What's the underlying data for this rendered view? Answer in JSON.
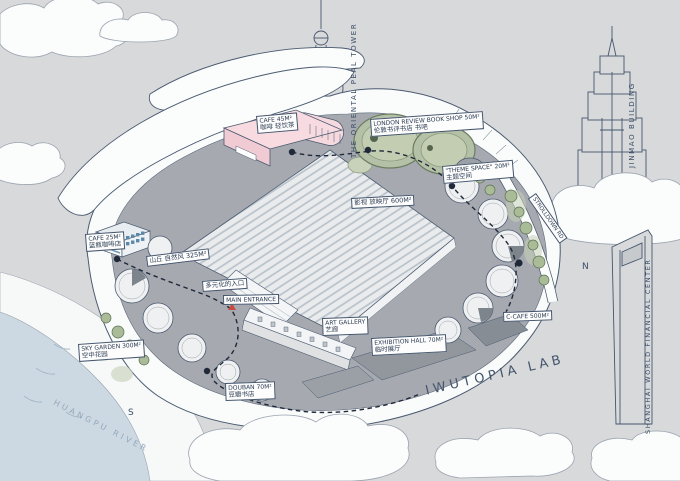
{
  "site": {
    "name": "IWUTOPIA LAB",
    "river": "HUANGPU RIVER",
    "compass_north": "N",
    "compass_south": "S"
  },
  "landmarks": {
    "pearl": "THE ORIENTAL PEAL TOWER",
    "jinmao": "JINMAO BUILDING",
    "swfc": "SHANGHAI WORLD FINANCIAL CENTER"
  },
  "labels": {
    "cafe_top": {
      "en": "CAFE 45M²",
      "zh": "咖啡 轻饮茶"
    },
    "bookshop": {
      "en": "LONDON REVIEW BOOK SHOP 50M²",
      "zh": "伦敦书评书店 书吧"
    },
    "theme_space": {
      "en": "\"THEME SPACE\" 20M²",
      "zh": "主题空间"
    },
    "cinema": {
      "zh": "影视 放映厅 600M²"
    },
    "stroll_road": {
      "en": "STROLLDOWN RD"
    },
    "cafe_left": {
      "en": "CAFE 25M²",
      "zh": "蓝瓶咖啡店"
    },
    "hill": {
      "zh": "山丘 自然风 325M²"
    },
    "entrance_cn": {
      "zh": "多元化的入口"
    },
    "main_entrance": {
      "en": "MAIN ENTRANCE"
    },
    "art_gallery": {
      "en": "ART GALLERY",
      "zh": "艺廊"
    },
    "exhibition": {
      "en": "EXHIBITION HALL 70M²",
      "zh": "临时展厅"
    },
    "c_cafe": {
      "en": "C-CAFE 500M²"
    },
    "sky_garden": {
      "en": "SKY GARDEN 300M²",
      "zh": "空中花园"
    },
    "douban": {
      "en": "DOUBAN 70M²",
      "zh": "豆瓣书店"
    }
  },
  "colors": {
    "background": "#d8d9da",
    "ink": "#3c4d66",
    "pink_building": "#f7dbe0",
    "green_bookshop": "#b5c1a6",
    "roof_grey": "#a6aab0",
    "river_blue": "#cdd9e2",
    "path_black": "#20293a",
    "entrance_marker_red": "#c84b42",
    "cafe_stripe_blue": "#6f9cbd"
  }
}
